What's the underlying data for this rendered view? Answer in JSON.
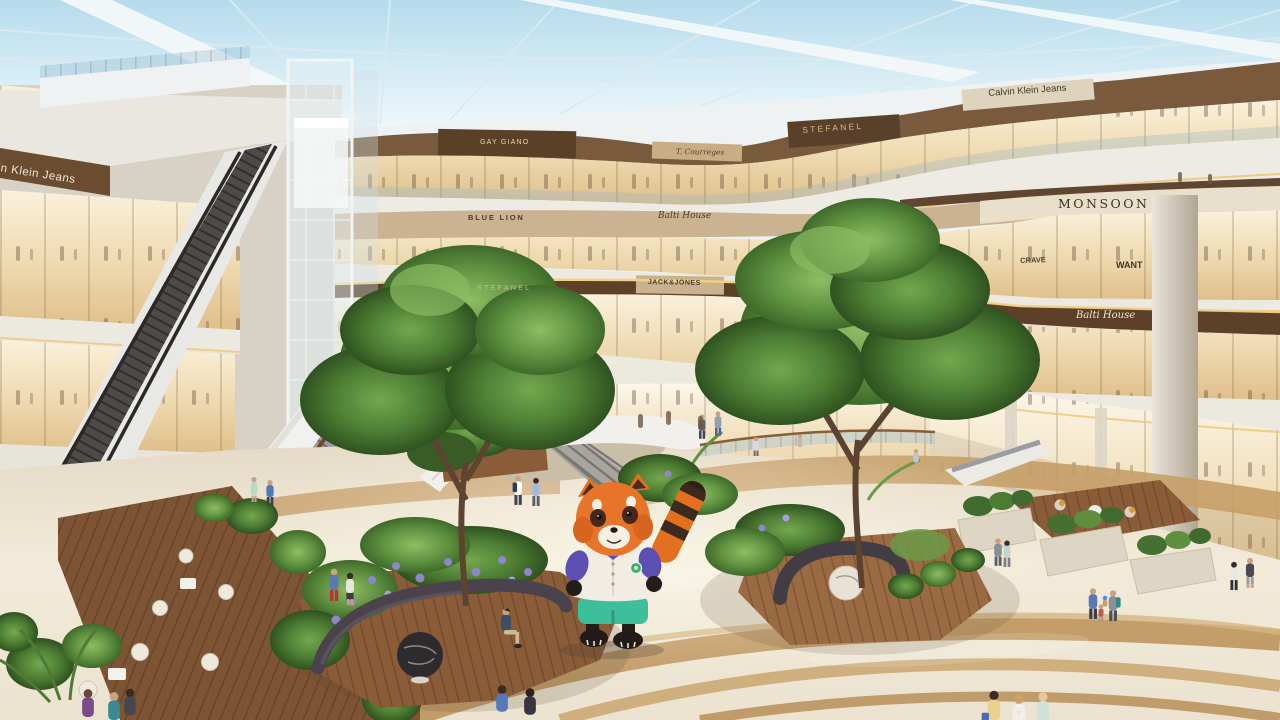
{
  "scene": {
    "setting": "Shopping mall atrium interior rendering with glass skylight roof",
    "floors_visible": 4,
    "mascot_character": "red panda costume figure"
  },
  "signs": {
    "calvin_klein_left": "Calvin Klein Jeans",
    "calvin_klein_top": "Calvin Klein Jeans",
    "gay_giano": "GAY GIANO",
    "courreges": "T. Courreges",
    "stefanel_upper": "STEFANEL",
    "blue_lion": "BLUE LION",
    "balti_house_center": "Balti House",
    "stefanel_mid": "STEFANEL",
    "jack_jones": "JACK&JONES",
    "monsoon": "MONSOON",
    "crave": "CRAVE",
    "want": "WANT",
    "balti_house_right": "Balti House"
  },
  "mascot": {
    "character": "red panda",
    "fur_color": "#e8742a",
    "shirt_color": "#f2ede3",
    "sleeve_color": "#5b4fb4",
    "shorts_color": "#3dbf9b",
    "badge_color": "#3fae62"
  },
  "palette": {
    "sky": "#c9e4ef",
    "roof_structure": "#f2f7f9",
    "fascia_brown": "#5f4630",
    "storefront_glow": "#f3e3c2",
    "balcony_white": "#edebe4",
    "floor_cream": "#efe8d8",
    "floor_band_tan": "#c19a63",
    "wood_deck": "#82573a",
    "foliage_green": "#4f7a35",
    "bench_charcoal": "#45404a"
  }
}
